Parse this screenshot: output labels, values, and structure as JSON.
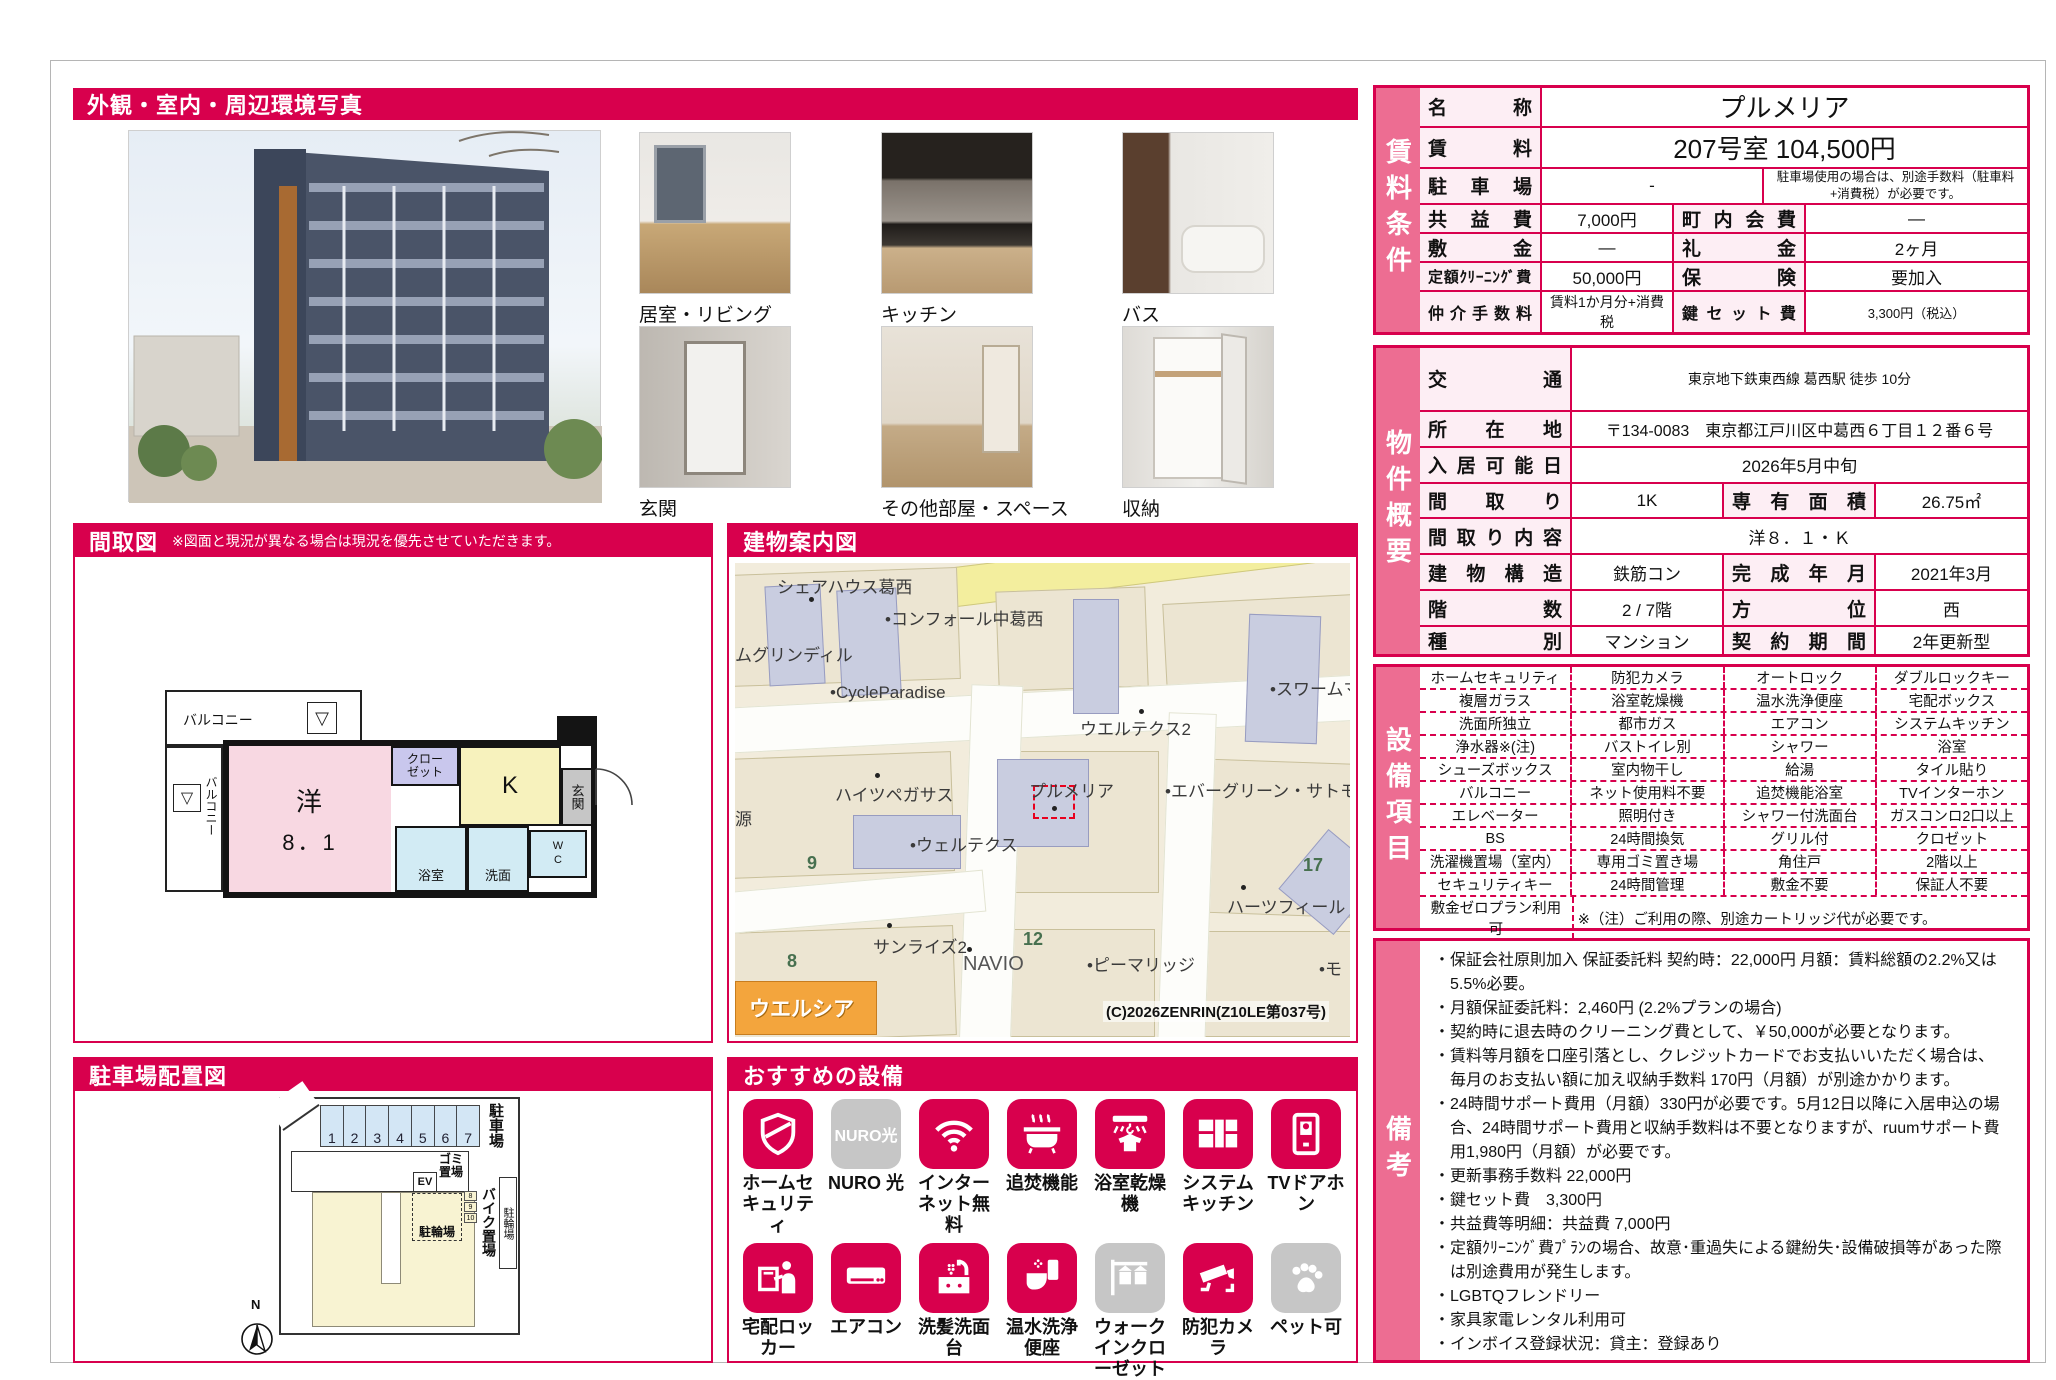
{
  "colors": {
    "accent": "#d8004d",
    "side_strip": "#ed6d92",
    "label_bg": "#fdeef4",
    "tile_gray": "#c6c6c6"
  },
  "photos": {
    "title": "外観・室内・周辺環境写真",
    "captions": [
      "居室・リビング",
      "キッチン",
      "バス",
      "玄関",
      "その他部屋・スペース",
      "収納"
    ]
  },
  "floorplan": {
    "title": "間取図",
    "note": "※図面と現況が異なる場合は現況を優先させていただきます。",
    "labels": {
      "balcony_top": "バルコニー",
      "balcony_left": "バルコニー",
      "room": "洋",
      "size": "8．1",
      "closet1": "クロー",
      "closet2": "ゼット",
      "kitchen": "K",
      "entrance": "玄関",
      "bath": "浴室",
      "wash": "洗面",
      "wc": "WC",
      "tri": "▽"
    }
  },
  "map": {
    "title": "建物案内図",
    "labels": [
      "シェアハウス葛西",
      "•コンフォール中葛西",
      "ムグリンディル",
      "•CycleParadise",
      "•スワームマ",
      "ウエルテクス2",
      "ハイツペガサス",
      "プルメリア",
      "•エバーグリーン・サトモ",
      "源",
      "9",
      "•ウェルテクス",
      "17",
      "ハーツフィールド",
      "サンライズ2",
      "12",
      "NAVIO",
      "•ピーマリッジ",
      "•モ",
      "8",
      "ウエルシア",
      "(C)2026ZENRIN(Z10LE第037号)"
    ]
  },
  "parking": {
    "title": "駐車場配置図",
    "stalls": [
      "1",
      "2",
      "3",
      "4",
      "5",
      "6",
      "7"
    ],
    "mini_stalls": [
      "8",
      "9",
      "10"
    ],
    "labels": {
      "parking": "駐車場",
      "garbage": "ゴミ置場",
      "ev": "EV",
      "bicycle": "駐輪場",
      "bike": "バイク置場",
      "bicycle_right": "駐輪場",
      "compass": "N"
    }
  },
  "equipment": {
    "title": "おすすめの設備",
    "items": [
      {
        "label": "ホームセキュリティ",
        "icon": "shield",
        "gray": false
      },
      {
        "label": "NURO 光",
        "icon": "nuro",
        "gray": true,
        "tile_text": "NURO光"
      },
      {
        "label": "インターネット無料",
        "icon": "wifi",
        "gray": false
      },
      {
        "label": "追焚機能",
        "icon": "bath",
        "gray": false
      },
      {
        "label": "浴室乾燥機",
        "icon": "dryer",
        "gray": false
      },
      {
        "label": "システムキッチン",
        "icon": "kitchen",
        "gray": false
      },
      {
        "label": "TVドアホン",
        "icon": "doorphone",
        "gray": false
      },
      {
        "label": "宅配ロッカー",
        "icon": "locker",
        "gray": false
      },
      {
        "label": "エアコン",
        "icon": "aircon",
        "gray": false
      },
      {
        "label": "洗髪洗面台",
        "icon": "sink",
        "gray": false
      },
      {
        "label": "温水洗浄便座",
        "icon": "toilet",
        "gray": false
      },
      {
        "label": "ウォークインクローゼット",
        "icon": "closet",
        "gray": true
      },
      {
        "label": "防犯カメラ",
        "icon": "cctv",
        "gray": false
      },
      {
        "label": "ペット可",
        "icon": "paw",
        "gray": true
      }
    ]
  },
  "rental": {
    "side": "賃料条件",
    "name_label": "名称",
    "name": "プルメリア",
    "rent_label": "賃料",
    "rent": "207号室 104,500円",
    "parking_label": "駐車場",
    "parking_value": "-",
    "parking_note": "駐車場使用の場合は、別途手数料（駐車料+消費税）が必要です。",
    "rows": [
      [
        "共益費",
        "7,000円",
        "町内会費",
        "―"
      ],
      [
        "敷金",
        "―",
        "礼金",
        "2ヶ月"
      ],
      [
        "定額ｸﾘｰﾆﾝｸﾞ費",
        "50,000円",
        "保険",
        "要加入"
      ],
      [
        "仲介手数料",
        "賃料1か月分+消費税",
        "鍵セット費",
        "3,300円（税込）"
      ]
    ]
  },
  "overview": {
    "side": "物件概要",
    "rows2": [
      [
        "交通",
        "東京地下鉄東西線 葛西駅 徒歩 10分"
      ],
      [
        "所在地",
        "〒134-0083　東京都江戸川区中葛西６丁目１２番６号"
      ],
      [
        "入居可能日",
        "2026年5月中旬"
      ]
    ],
    "row4a": [
      "間取り",
      "1K",
      "専有面積",
      "26.75㎡"
    ],
    "layout_label": "間取り内容",
    "layout": "洋８．１・Ｋ",
    "rows4": [
      [
        "建物構造",
        "鉄筋コン",
        "完成年月",
        "2021年3月"
      ],
      [
        "階数",
        "2 / 7階",
        "方位",
        "西"
      ],
      [
        "種別",
        "マンション",
        "契約期間",
        "2年更新型"
      ]
    ]
  },
  "features": {
    "side": "設備項目",
    "rows": [
      [
        "ホームセキュリティ",
        "防犯カメラ",
        "オートロック",
        "ダブルロックキー"
      ],
      [
        "複層ガラス",
        "浴室乾燥機",
        "温水洗浄便座",
        "宅配ボックス"
      ],
      [
        "洗面所独立",
        "都市ガス",
        "エアコン",
        "システムキッチン"
      ],
      [
        "浄水器※(注)",
        "バストイレ別",
        "シャワー",
        "浴室"
      ],
      [
        "シューズボックス",
        "室内物干し",
        "給湯",
        "タイル貼り"
      ],
      [
        "バルコニー",
        "ネット使用料不要",
        "追焚機能浴室",
        "TVインターホン"
      ],
      [
        "エレベーター",
        "照明付き",
        "シャワー付洗面台",
        "ガスコンロ2口以上"
      ],
      [
        "BS",
        "24時間換気",
        "グリル付",
        "クロゼット"
      ],
      [
        "洗濯機置場（室内）",
        "専用ゴミ置き場",
        "角住戸",
        "2階以上"
      ],
      [
        "セキュリティキー",
        "24時間管理",
        "敷金不要",
        "保証人不要"
      ]
    ],
    "footer_label": "敷金ゼロプラン利用可",
    "footer_note": "※（注）ご利用の際、別途カートリッジ代が必要です。"
  },
  "remarks": {
    "side": "備考",
    "items": [
      "保証会社原則加入 保証委託料 契約時：22,000円 月額：賃料総額の2.2%又は5.5%必要。",
      "月額保証委託料：2,460円 (2.2%プランの場合)",
      "契約時に退去時のクリーニング費として、￥50,000が必要となります。",
      "賃料等月額を口座引落とし、クレジットカードでお支払いいただく場合は、　毎月のお支払い額に加え収納手数料 170円（月額）が別途かかります。",
      "24時間サポート費用（月額）330円が必要です。5月12日以降に入居申込の場合、24時間サポート費用と収納手数料は不要となりますが、ruumサポート費用1,980円（月額）が必要です。",
      "更新事務手数料 22,000円",
      "鍵セット費　3,300円",
      "共益費等明細：共益費 7,000円",
      "定額ｸﾘｰﾆﾝｸﾞ費ﾌﾟﾗﾝの場合、故意･重過失による鍵紛失･設備破損等があった際は別途費用が発生します。",
      "LGBTQフレンドリー",
      "家具家電レンタル利用可",
      "インボイス登録状況：貸主：登録あり"
    ]
  }
}
